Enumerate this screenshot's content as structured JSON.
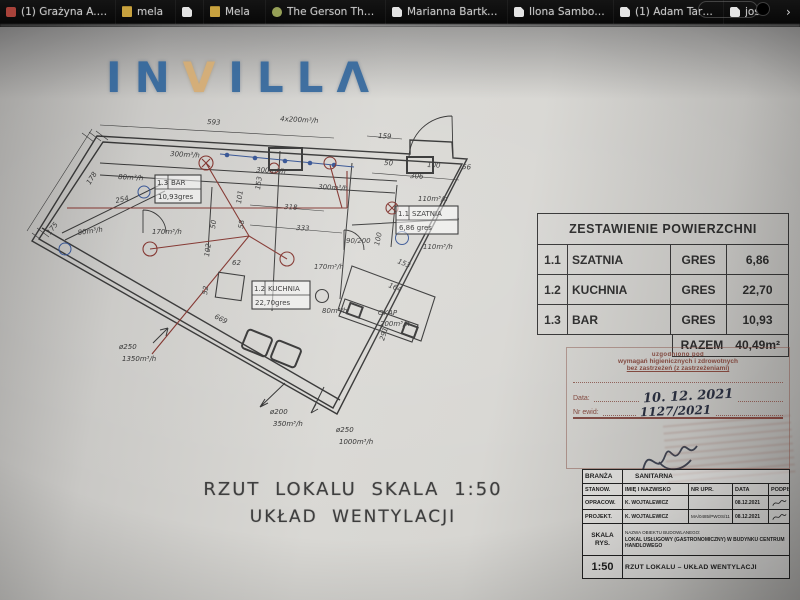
{
  "browser": {
    "tabs": [
      {
        "label": "(1) Grażyna A. Ada..."
      },
      {
        "label": "mela"
      },
      {
        "label": ""
      },
      {
        "label": "Mela"
      },
      {
        "label": "The Gerson Therap..."
      },
      {
        "label": "Marianna Bartke Th..."
      },
      {
        "label": "Ilona Samborska"
      },
      {
        "label": "(1) Adam Tarunt"
      },
      {
        "label": "jose"
      }
    ],
    "overflow": "›"
  },
  "logo": {
    "pre": "IN",
    "v": "V",
    "post": "ILLΛ"
  },
  "plan": {
    "title_line1": "RZUT LOKALU SKALA 1:50",
    "title_line2": "UKŁAD WENTYLACJI",
    "labels": [
      {
        "t": "593",
        "x": 185,
        "y": 13,
        "r": 3
      },
      {
        "t": "4x200m³/h",
        "x": 258,
        "y": 10,
        "r": 3
      },
      {
        "t": "159",
        "x": 356,
        "y": 27,
        "r": 3
      },
      {
        "t": "300m³/h",
        "x": 148,
        "y": 45,
        "r": 3
      },
      {
        "t": "300m³/h",
        "x": 234,
        "y": 61,
        "r": 3
      },
      {
        "t": "300m³/h",
        "x": 296,
        "y": 78,
        "r": 3
      },
      {
        "t": "80m³/h",
        "x": 96,
        "y": 68,
        "r": 3
      },
      {
        "t": "178",
        "x": 68,
        "y": 74,
        "r": -58
      },
      {
        "t": "254",
        "x": 94,
        "y": 92,
        "r": -12
      },
      {
        "t": "80m³/h",
        "x": 56,
        "y": 124,
        "r": -8
      },
      {
        "t": "175",
        "x": 28,
        "y": 124,
        "r": -52
      },
      {
        "t": "170m³/h",
        "x": 130,
        "y": 123,
        "r": 0
      },
      {
        "t": "170m³/h",
        "x": 292,
        "y": 158,
        "r": 0
      },
      {
        "t": "80m³/h",
        "x": 300,
        "y": 202,
        "r": 0
      },
      {
        "t": "110m³/h",
        "x": 396,
        "y": 90,
        "r": 0
      },
      {
        "t": "110m³/h",
        "x": 401,
        "y": 138,
        "r": 0
      },
      {
        "t": "306",
        "x": 388,
        "y": 67,
        "r": 3
      },
      {
        "t": "50",
        "x": 362,
        "y": 54,
        "r": 3
      },
      {
        "t": "100",
        "x": 405,
        "y": 56,
        "r": 3
      },
      {
        "t": "56",
        "x": 440,
        "y": 58,
        "r": 3
      },
      {
        "t": "318",
        "x": 262,
        "y": 98,
        "r": 3
      },
      {
        "t": "333",
        "x": 274,
        "y": 119,
        "r": 3
      },
      {
        "t": "101",
        "x": 219,
        "y": 93,
        "r": -82
      },
      {
        "t": "153",
        "x": 238,
        "y": 79,
        "r": -82
      },
      {
        "t": "58",
        "x": 221,
        "y": 118,
        "r": -82
      },
      {
        "t": "50",
        "x": 193,
        "y": 118,
        "r": -82
      },
      {
        "t": "102",
        "x": 187,
        "y": 146,
        "r": -82
      },
      {
        "t": "52",
        "x": 185,
        "y": 184,
        "r": -82
      },
      {
        "t": "62",
        "x": 210,
        "y": 154,
        "r": 0
      },
      {
        "t": "669",
        "x": 192,
        "y": 207,
        "r": 27
      },
      {
        "t": "90/200",
        "x": 324,
        "y": 132,
        "r": 0,
        "fs": 6
      },
      {
        "t": "100",
        "x": 357,
        "y": 135,
        "r": -78
      },
      {
        "t": "153",
        "x": 375,
        "y": 152,
        "r": 22
      },
      {
        "t": "164",
        "x": 366,
        "y": 176,
        "r": 22
      },
      {
        "t": "291",
        "x": 362,
        "y": 230,
        "r": -73
      },
      {
        "t": "OKAP",
        "x": 356,
        "y": 204,
        "r": 0
      },
      {
        "t": "200m³/h",
        "x": 358,
        "y": 215,
        "r": 0
      },
      {
        "t": "ø250",
        "x": 97,
        "y": 238,
        "r": 0
      },
      {
        "t": "1350m³/h",
        "x": 100,
        "y": 250,
        "r": 0
      },
      {
        "t": "ø200",
        "x": 248,
        "y": 303,
        "r": 0
      },
      {
        "t": "350m³/h",
        "x": 251,
        "y": 315,
        "r": 0
      },
      {
        "t": "ø250",
        "x": 314,
        "y": 321,
        "r": 0
      },
      {
        "t": "1000m³/h",
        "x": 317,
        "y": 333,
        "r": 0
      }
    ],
    "rooms": [
      {
        "id": "1.3",
        "name": "BAR",
        "bottom": "10,93gres",
        "x": 133,
        "y": 64,
        "w": 46,
        "h": 28
      },
      {
        "id": "1.2",
        "name": "KUCHNIA",
        "bottom": "22,70gres",
        "x": 230,
        "y": 170,
        "w": 58,
        "h": 28
      },
      {
        "id": "1.1",
        "name": "SZATNIA",
        "bottom": "6,86 gres",
        "x": 374,
        "y": 95,
        "w": 62,
        "h": 28
      }
    ]
  },
  "area_table": {
    "title": "ZESTAWIENIE POWIERZCHNI",
    "rows": [
      {
        "no": "1.1",
        "name": "SZATNIA",
        "finish": "GRES",
        "area": "6,86"
      },
      {
        "no": "1.2",
        "name": "KUCHNIA",
        "finish": "GRES",
        "area": "22,70"
      },
      {
        "no": "1.3",
        "name": "BAR",
        "finish": "GRES",
        "area": "10,93"
      }
    ],
    "total_label": "RAZEM",
    "total_value": "40,49m²"
  },
  "stamp": {
    "line0": "uzgodniono pod",
    "line1": "wymagań higienicznych i zdrowotnych",
    "line2": "bez zastrzeżeń (z zastrzeżeniami)",
    "date_label": "Data:",
    "date_value": "10. 12. 2021",
    "evid_label": "Nr ewid:",
    "evid_value": "1127/2021"
  },
  "title_block": {
    "branza_label": "BRANŻA",
    "branza_value": "SANITARNA",
    "col_stanow": "STANOW.",
    "col_name": "IMIĘ I NAZWISKO",
    "col_upr": "NR UPR.",
    "col_data": "DATA",
    "col_podpis": "PODPIS",
    "rows": [
      {
        "role": "OPRACOW.",
        "name": "K. WOJTALEWICZ",
        "upr": "",
        "date": "08.12.2021"
      },
      {
        "role": "PROJEKT.",
        "name": "K. WOJTALEWICZ",
        "upr": "MA/0485/PWOS/11",
        "date": "08.12.2021"
      }
    ],
    "skala_label": "SKALA RYS.",
    "object_label": "NAZWA OBIEKTU BUDOWLANEGO:",
    "object_value": "LOKAL USŁUGOWY (GASTRONOMICZNY) W BUDYNKU CENTRUM HANDLOWEGO",
    "scale": "1:50",
    "drawing_title": "RZUT LOKALU – UKŁAD WENTYLACJI"
  }
}
